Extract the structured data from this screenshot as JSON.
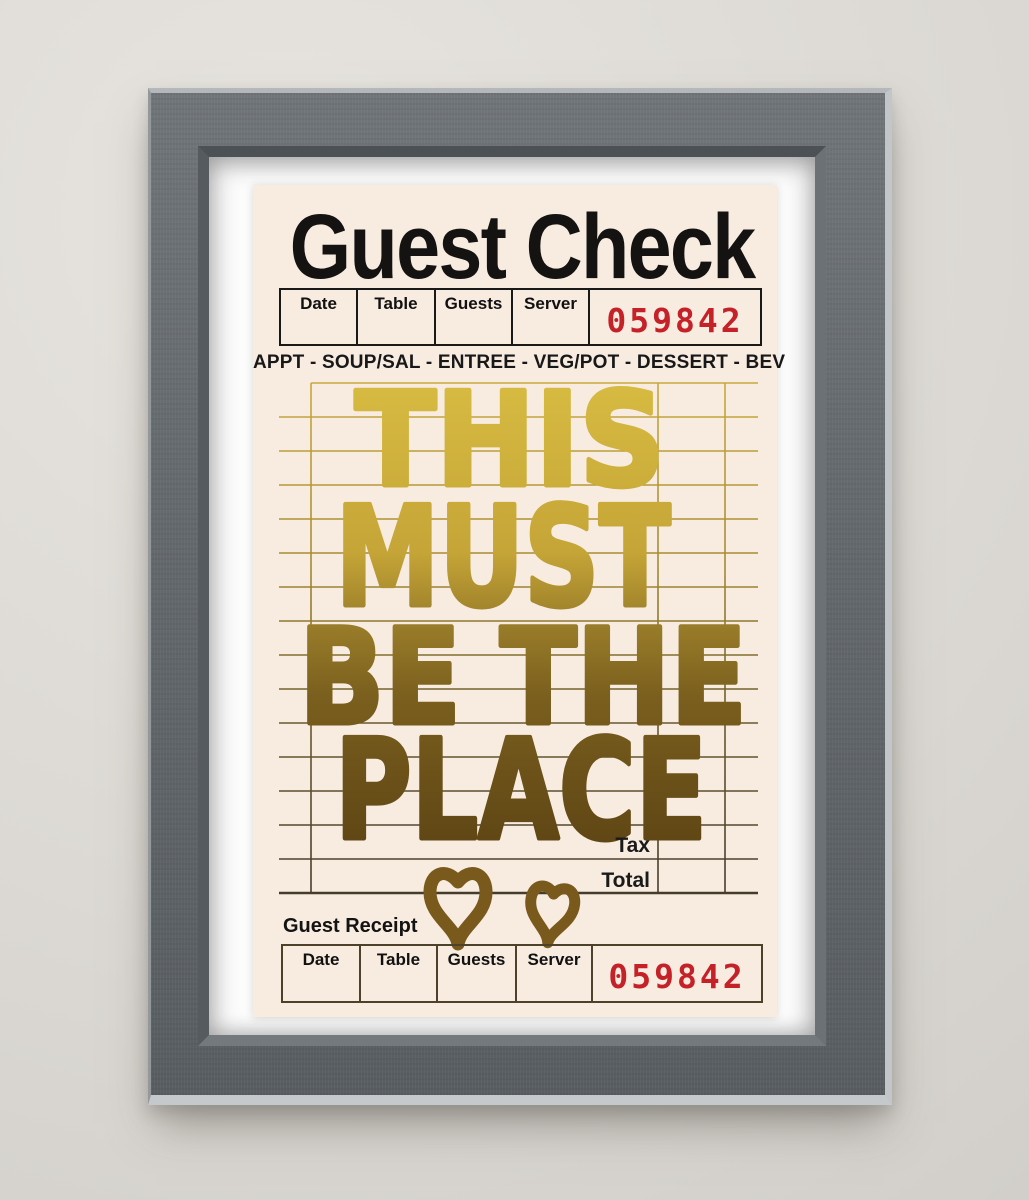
{
  "poster": {
    "title": "Guest Check",
    "menu_line": "APPT - SOUP/SAL - ENTREE - VEG/POT - DESSERT - BEV",
    "check_header": {
      "columns": [
        "Date",
        "Table",
        "Guests",
        "Server"
      ],
      "check_number": "059842"
    },
    "message_lines": [
      "THIS",
      "MUST",
      "BE THE",
      "PLACE"
    ],
    "totals": {
      "tax_label": "Tax",
      "total_label": "Total"
    },
    "receipt": {
      "section_label": "Guest Receipt",
      "columns": [
        "Date",
        "Table",
        "Guests",
        "Server"
      ],
      "check_number": "059842"
    },
    "colors": {
      "paper": "#f8ece1",
      "check_number_red": "#c52128",
      "gold_top": "#d8bc42",
      "gold_bottom": "#5e4514",
      "heart_brown": "#7a591d"
    }
  },
  "scene": {
    "frame_color": "#63686c",
    "mat_color": "#fcfcfc",
    "wall_color": "#dcd9d4"
  }
}
